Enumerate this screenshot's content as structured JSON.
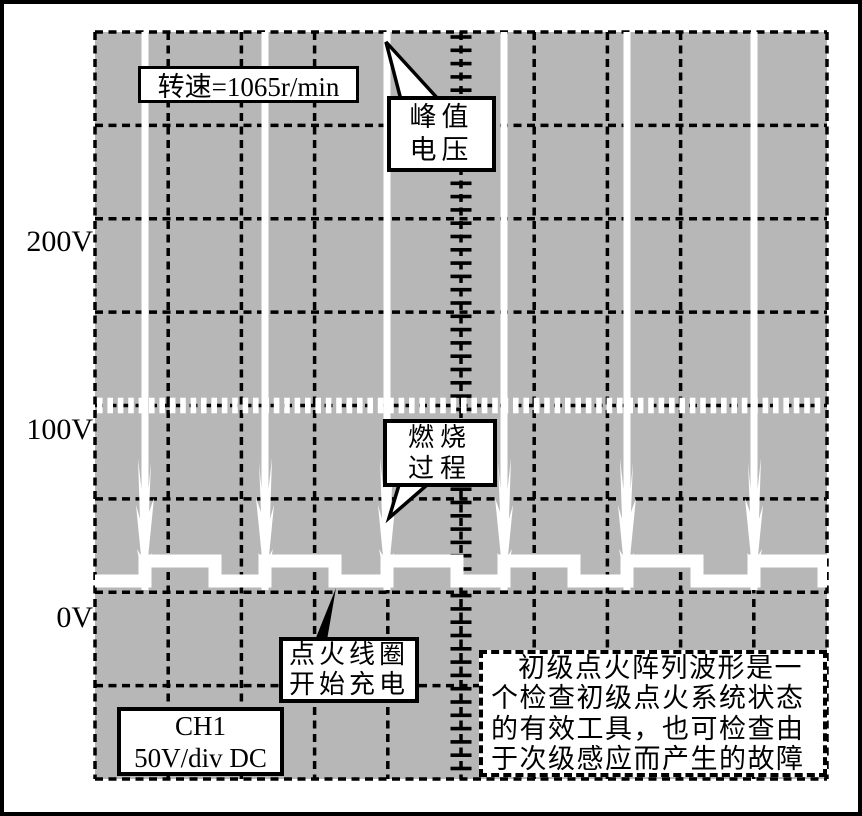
{
  "figure": {
    "kind": "oscilloscope waveform diagram",
    "channel_label": [
      "CH1",
      "50V/div DC"
    ]
  },
  "y_axis": {
    "labels": [
      "200V",
      "100V",
      "0V"
    ]
  },
  "annotations": {
    "rpm": {
      "text": "转速=1065r/min"
    },
    "peak_voltage": {
      "lines": [
        "峰值",
        "电压"
      ]
    },
    "combustion": {
      "lines": [
        "燃烧",
        "过程"
      ]
    },
    "coil_charging": {
      "lines": [
        "点火线圈",
        "开始充电"
      ]
    },
    "note": {
      "lines": [
        "初级点火阵列波形是一",
        "个检查初级点火系统状态",
        "的有效工具，也可检查由",
        "于次级感应而产生的故障"
      ]
    }
  },
  "grid": {
    "h_divisions": 10,
    "v_divisions": 8,
    "volts_per_division": 50
  },
  "colors": {
    "screen_bg": "#b7b7b7",
    "grid_line": "#000000",
    "trace": "#ffffff",
    "frame": "#000000"
  },
  "chart_data": {
    "type": "line",
    "title": "primary ignition parade waveform",
    "ylabel": "V",
    "y_tick_labels": [
      "200V",
      "100V",
      "0V"
    ],
    "volts_per_div": 50,
    "ylim": [
      -100,
      300
    ],
    "ignition_events": 6,
    "series": [
      {
        "name": "CH1 50V/div DC",
        "dwell_voltage_V": 5,
        "burn_voltage_V": 15,
        "peak_voltage": "clipped above 300V",
        "engine_speed": "1065 r/min"
      }
    ],
    "waveform_px": {
      "grid_rect": [
        95,
        32,
        732,
        747
      ],
      "spike_positions": [
        145,
        265,
        387,
        504,
        627,
        754
      ],
      "dwell_level": 581,
      "burn_level": 561,
      "burn_end_offset": 70,
      "trace_thickness": 13,
      "spike_thickness": 7
    }
  }
}
